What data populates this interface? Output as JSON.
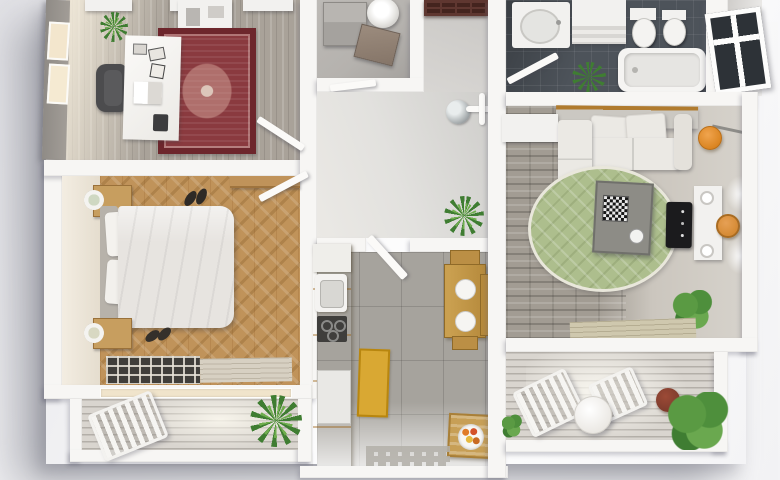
{
  "scene": {
    "kind": "3d-floor-plan-render",
    "view": "top-down",
    "description": "Photorealistic 3D floor plan render of an apartment with office, bedroom, hallway, utility room, kitchen, bathroom, living room and two balconies",
    "visible_text": ""
  },
  "palette": {
    "background": "#f2f2f4",
    "wall_white": "#f7f6f4",
    "office_floor_grey": "#a9a299",
    "rug_red": "#8a3a3f",
    "rug_red_border": "#6d262c",
    "bedroom_floor_tan": "#c0935a",
    "bed_linen_white": "#e7e4e0",
    "balcony_deck_grey": "#d9d5cf",
    "hallway_floor_grey": "#dcdbd8",
    "utility_floor_grey": "#b5b2ae",
    "kitchen_floor_grey": "#a6a39d",
    "kitchen_cabinet_yellow": "#f2a42f",
    "kitchen_mat_yellow": "#d9a833",
    "dining_table_wood": "#b68a3c",
    "fruit_crate_tan": "#c79f56",
    "bathroom_tile_slate": "#4d535a",
    "fixture_white": "#f2f1ef",
    "living_floor_stone": "#9d978e",
    "living_floor_light": "#d6d2cb",
    "living_rug_green": "#adbe8d",
    "sofa_white": "#ebe9e4",
    "accent_orange": "#d68b35",
    "tv_black": "#1b1b1d",
    "entry_door_brown": "#5f3730",
    "plant_green": "#3f7d32",
    "wood_trim_tan": "#b07b2e"
  },
  "rooms": [
    {
      "id": "office",
      "label": "Home office",
      "floor": "grey wood planks",
      "furniture": [
        "white desk with papers",
        "dark office chair",
        "red oriental rug",
        "potted plant",
        "ceiling light panels",
        "wall cabinet",
        "window on left wall"
      ]
    },
    {
      "id": "bedroom",
      "label": "Bedroom",
      "floor": "tan herringbone parquet",
      "furniture": [
        "double bed with white duvet",
        "two pillows",
        "two wooden nightstands with lamps",
        "wardrobe",
        "two pairs of shoes",
        "dark grid rug",
        "beige runner",
        "window wall"
      ]
    },
    {
      "id": "balcony-left",
      "label": "Bedroom balcony",
      "floor": "wood decking",
      "furniture": [
        "folding lounge chair",
        "palm plant"
      ]
    },
    {
      "id": "utility",
      "label": "Utility room",
      "floor": "grey screed",
      "furniture": [
        "water boiler",
        "grey cabinet",
        "brown box"
      ]
    },
    {
      "id": "hallway",
      "label": "Entrance hall",
      "floor": "light grey",
      "furniture": [
        "brown entrance door",
        "round wall mirror",
        "white coat rack",
        "potted plant"
      ]
    },
    {
      "id": "kitchen",
      "label": "Kitchen",
      "floor": "grey tile",
      "furniture": [
        "yellow cabinet run",
        "sink",
        "dark cooktop",
        "white appliance",
        "yellow mat",
        "wooden dining table with two place settings",
        "two stools",
        "fruit crate with bowl",
        "grey grid mat",
        "open door"
      ]
    },
    {
      "id": "bathroom",
      "label": "Bathroom",
      "floor": "dark slate tile",
      "furniture": [
        "vanity with basin",
        "washer cabinet",
        "toilet",
        "bidet",
        "bathtub",
        "plant",
        "open door",
        "window on right wall"
      ]
    },
    {
      "id": "living-room",
      "label": "Living room",
      "floor": "grey stone planks",
      "furniture": [
        "white corner sofa",
        "wall canopy shelf with wood trim",
        "white side table",
        "round green rug",
        "grey coffee table with chessboard",
        "tv console",
        "flat tv",
        "orange pendant lamp",
        "orange stool",
        "wall sconces",
        "green plant",
        "beige rug"
      ]
    },
    {
      "id": "balcony-right",
      "label": "Living room balcony",
      "floor": "wood decking",
      "furniture": [
        "two folding chairs",
        "round white table",
        "plant in clay pot",
        "large green plant"
      ]
    }
  ]
}
